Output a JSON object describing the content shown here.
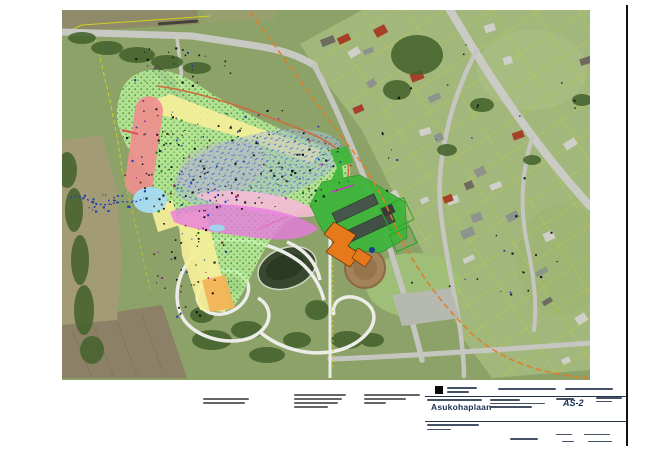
{
  "title_block": {
    "project_title": "Asukohaplaan",
    "drawing_code": "AS-2"
  },
  "map": {
    "kind": "aerial-orthophoto-site-plan",
    "overlay_colors": {
      "zone_light_green": "#bdf09c",
      "zone_yellow": "#f6ef9a",
      "zone_orange_band": "#f2b457",
      "zone_red": "#ef8f8f",
      "zone_magenta": "#e97ae0",
      "zone_pink": "#f5bcd6",
      "zone_light_blue": "#a6dcf2",
      "zone_gray_blue": "#a9bfc9",
      "site_green": "#3fb53b",
      "building_orange": "#e5791c",
      "boundary_dashed_orange": "#e87820",
      "cadastral_yellow": "#d8d816",
      "stream_blue": "#2540c0"
    }
  }
}
